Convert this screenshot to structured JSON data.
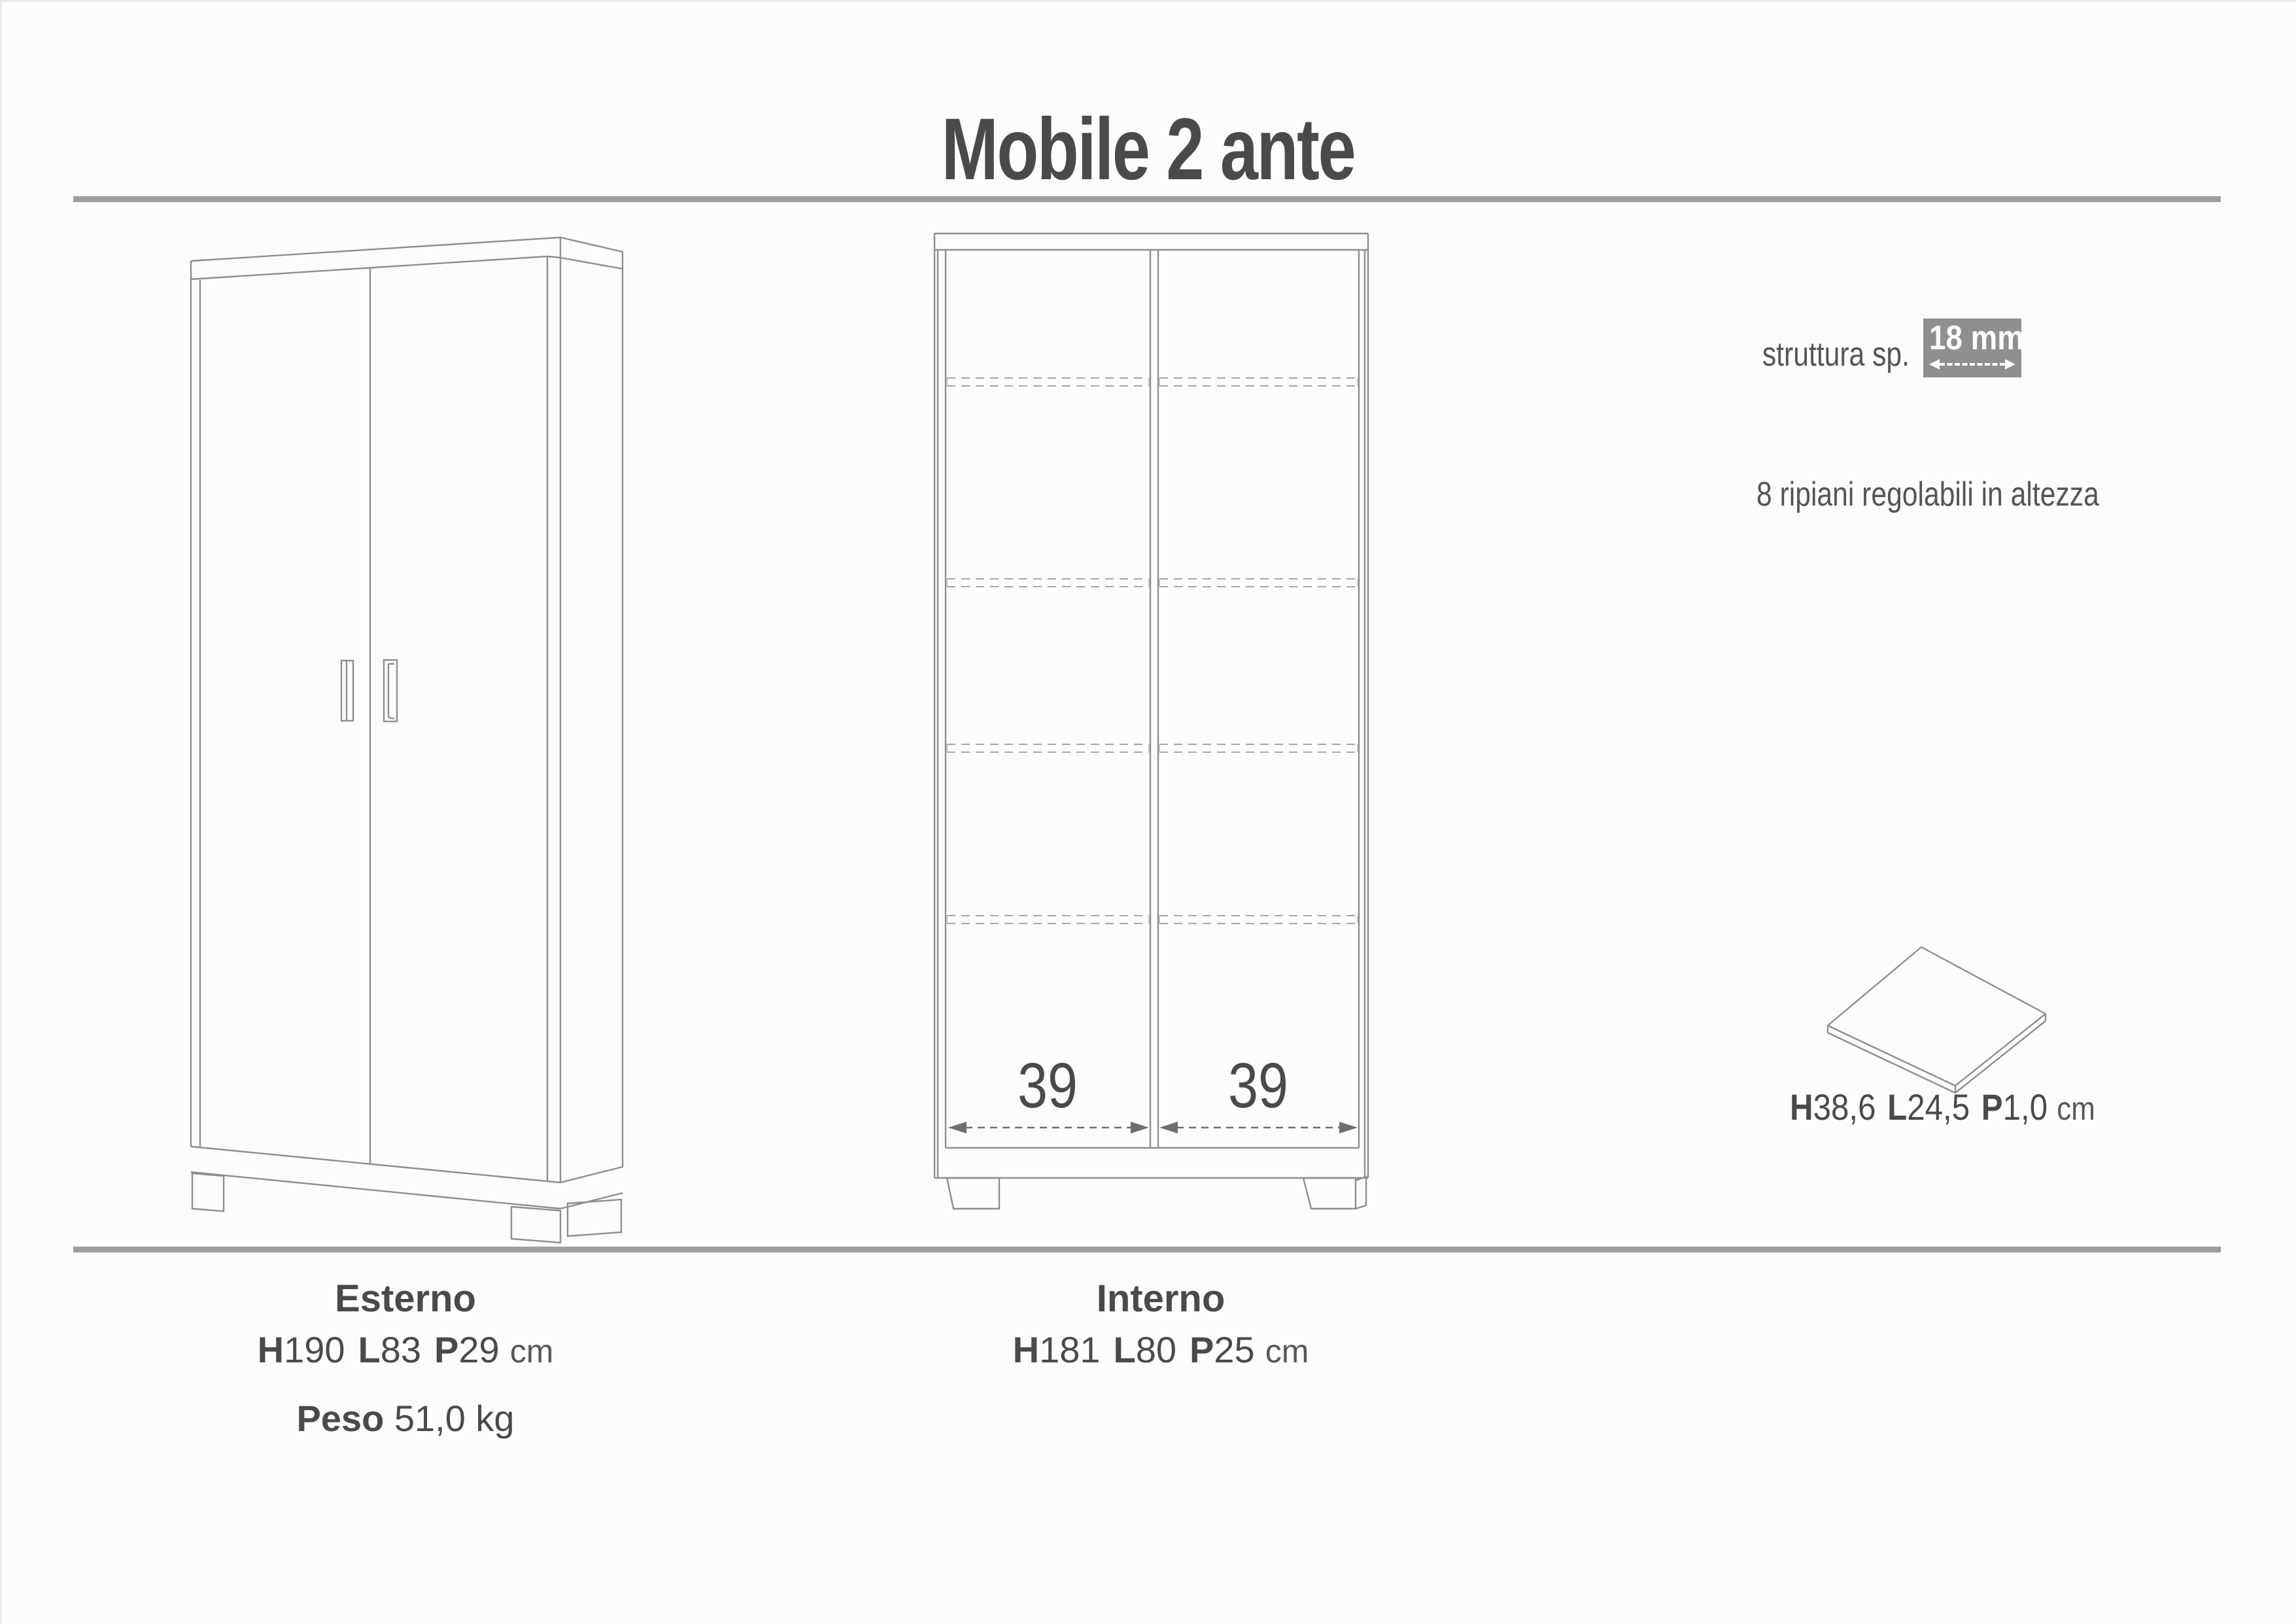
{
  "title": "Mobile 2 ante",
  "right_panel": {
    "structure_label": "struttura sp.",
    "structure_value": "18 mm",
    "shelves_note": "8 ripiani regolabili in altezza",
    "shelf_dims": {
      "h_label": "H",
      "h": "38,6",
      "l_label": "L",
      "l": "24,5",
      "p_label": "P",
      "p": "1,0",
      "unit": "cm"
    }
  },
  "front_view": {
    "left_width": "39",
    "right_width": "39"
  },
  "footer": {
    "esterno": {
      "heading": "Esterno",
      "h_label": "H",
      "h": "190",
      "l_label": "L",
      "l": "83",
      "p_label": "P",
      "p": "29",
      "unit": "cm",
      "peso_label": "Peso",
      "peso_value": "51,0 kg"
    },
    "interno": {
      "heading": "Interno",
      "h_label": "H",
      "h": "181",
      "l_label": "L",
      "l": "80",
      "p_label": "P",
      "p": "25",
      "unit": "cm"
    }
  },
  "colors": {
    "text_dark": "#4a4a4a",
    "line_gray": "#8e8e8e",
    "rule_gray": "#9e9e9e",
    "badge_bg": "#8f8f8f",
    "badge_text": "#ffffff",
    "dash_gray": "#a6a6a6",
    "arrow_gray": "#6e6e6e",
    "background": "#fcfcfc"
  }
}
